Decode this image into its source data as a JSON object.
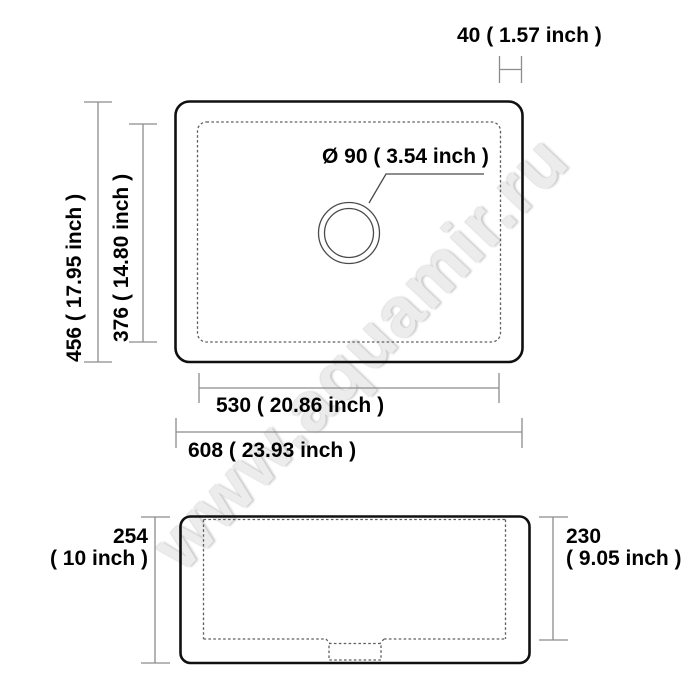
{
  "watermark": {
    "text": "www.aquamir.ru"
  },
  "colors": {
    "background": "#ffffff",
    "outline": "#101010",
    "dimension": "#8c8c8c",
    "dashed": "#5f5f5f",
    "label": "#000000",
    "watermark": "#ececec"
  },
  "top_view": {
    "rim_width_label": "40 ( 1.57 inch )",
    "outer_height_label": "456 ( 17.95 inch )",
    "inner_height_label": "376 ( 14.80 inch )",
    "drain_label": "Ø 90 ( 3.54 inch )",
    "inner_width_label": "530 ( 20.86 inch )",
    "outer_width_label": "608 ( 23.93 inch )"
  },
  "side_view": {
    "outer_height_value": "254",
    "outer_height_inch": "( 10 inch )",
    "inner_depth_value": "230",
    "inner_depth_inch": "( 9.05 inch )"
  }
}
